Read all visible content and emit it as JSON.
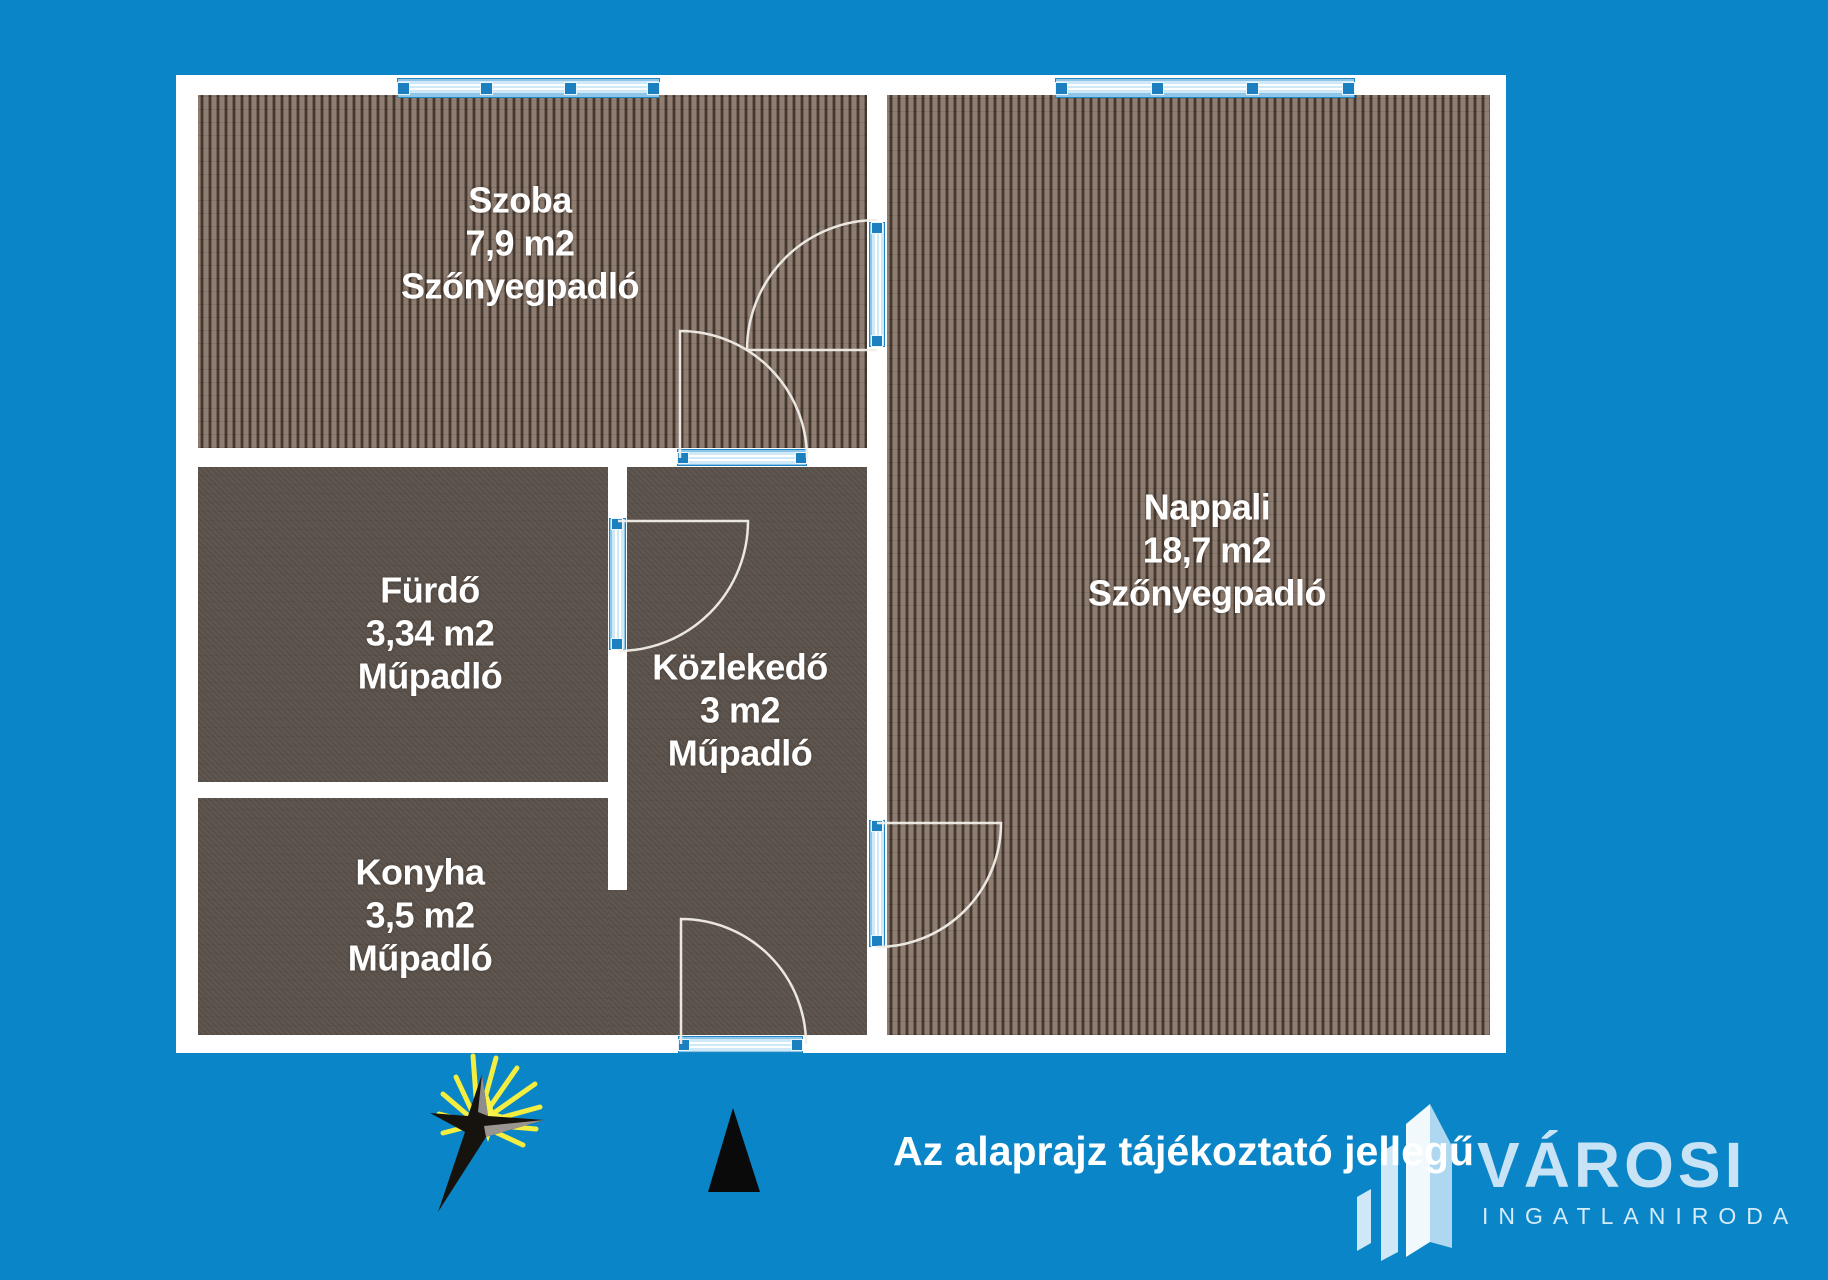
{
  "plan": {
    "rooms": [
      {
        "name": "Szoba",
        "area": "7,9 m2",
        "floor": "Szőnyegpadló"
      },
      {
        "name": "Nappali",
        "area": "18,7 m2",
        "floor": "Szőnyegpadló"
      },
      {
        "name": "Fürdő",
        "area": "3,34 m2",
        "floor": "Műpadló"
      },
      {
        "name": "Közlekedő",
        "area": "3 m2",
        "floor": "Műpadló"
      },
      {
        "name": "Konyha",
        "area": "3,5 m2",
        "floor": "Műpadló"
      }
    ],
    "window_count": 2,
    "door_count": 5
  },
  "footer": {
    "disclaimer": "Az alaprajz tájékoztató jellegű",
    "logo_title": "VÁROSI",
    "logo_subtitle": "INGATLANIRODA"
  },
  "icons": {
    "compass_star": "sun-star-icon",
    "north_arrow": "north-triangle-icon",
    "logo_mark": "buildings-icon"
  },
  "colors": {
    "background": "#0a85c7",
    "wall": "#ffffff",
    "carpet_dark": "#443931",
    "carpet_light": "#8e7d70",
    "vinyl_floor": "#5b524b",
    "opening_blue": "#1b7fc0",
    "opening_glass": "#cfe9f8",
    "label_text": "#ffffff",
    "logo_blue": "#c7e3f5",
    "star_yellow": "#f3ee3f",
    "north_black": "#0a0a0a"
  }
}
